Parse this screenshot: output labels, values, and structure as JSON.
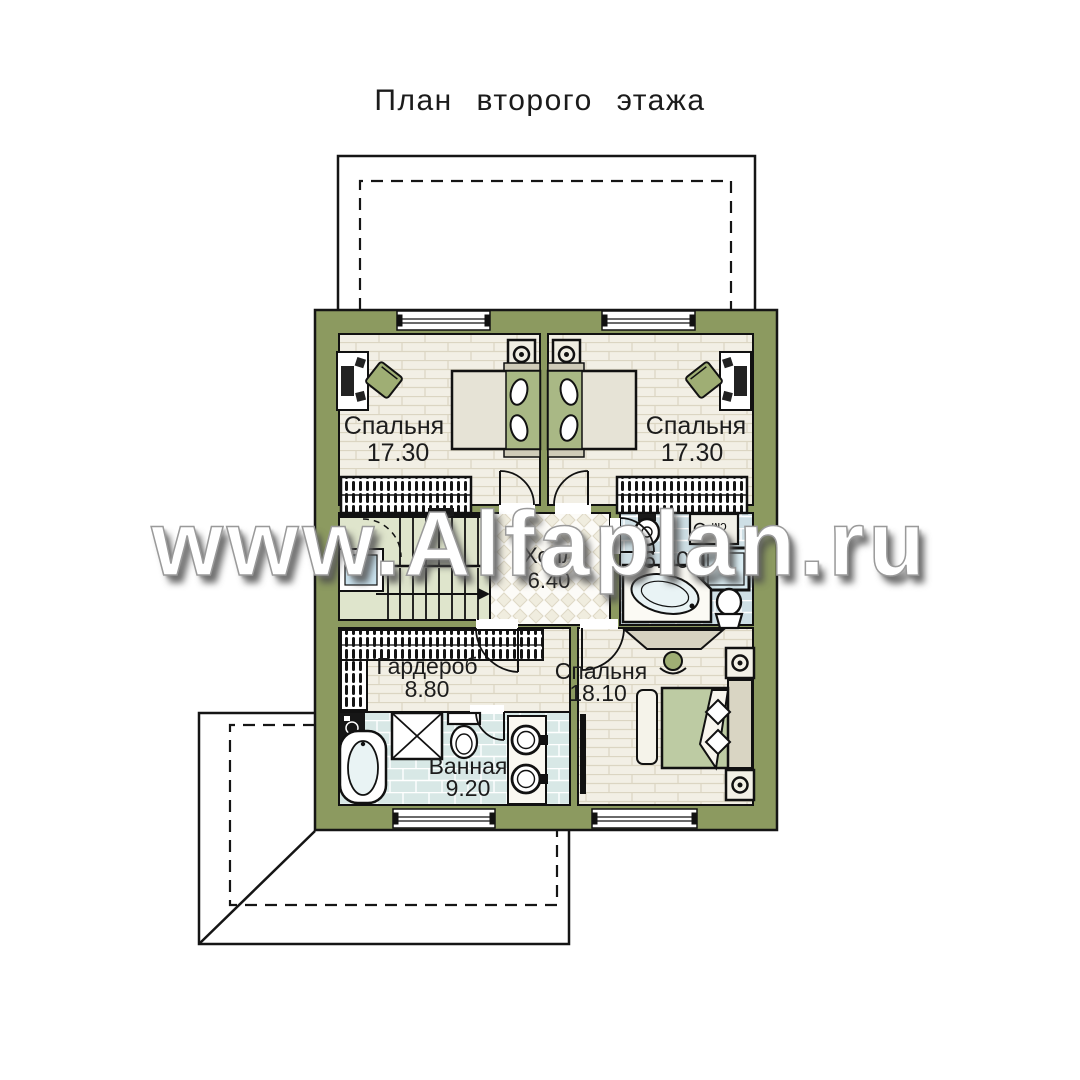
{
  "title": "План второго этажа",
  "watermark": "www.Alfaplan.ru",
  "rooms": [
    {
      "name": "Спальня",
      "area": "17.30"
    },
    {
      "name": "Спальня",
      "area": "17.30"
    },
    {
      "name": "Холл",
      "area": "6.40"
    },
    {
      "name": "",
      "area": "6.60"
    },
    {
      "name": "Гардероб",
      "area": "8.80"
    },
    {
      "name": "Спальня",
      "area": "18.10"
    },
    {
      "name": "Ванная",
      "area": "9.20"
    }
  ],
  "labels": {
    "washing_machine": "см"
  },
  "colors": {
    "wall": "#8C9A60",
    "floor_plank": "#F2EFE5",
    "floor_stairs": "#DFE5CC",
    "floor_tile_bath": "#D8E8E6",
    "floor_tile_wc": "#CEDFE5",
    "accent_textile": "#AFBE8E",
    "window_glass": "#CBE4F0",
    "outline": "#151515"
  }
}
